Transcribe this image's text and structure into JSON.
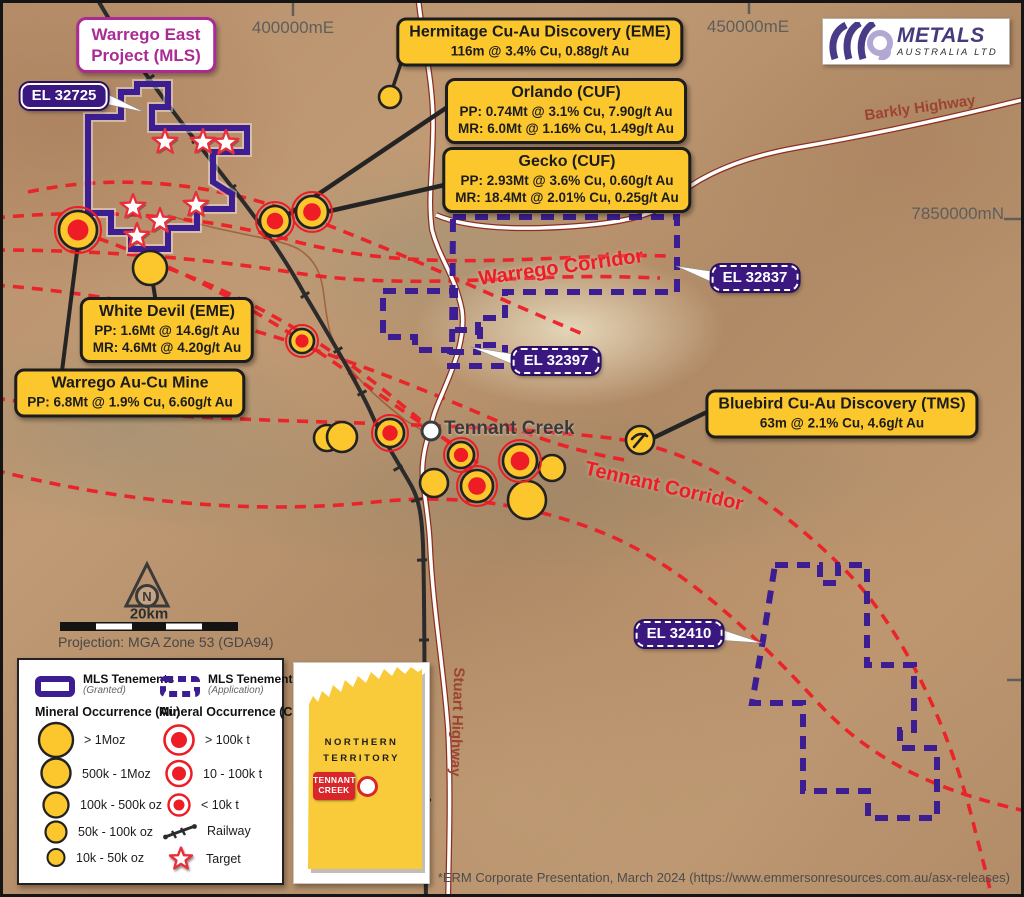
{
  "map": {
    "coordinates": {
      "e400": "400000mE",
      "e450": "450000mE",
      "n7850": "7850000mN"
    },
    "project_label": {
      "line1": "Warrego East",
      "line2": "Project (MLS)"
    },
    "tenement_labels": {
      "granted": "EL 32725",
      "app1": "EL 32837",
      "app2": "EL 32397",
      "app3": "EL 32410"
    },
    "corridors": {
      "warrego": "Warrego Corridor",
      "tennant": "Tennant Corridor"
    },
    "highways": {
      "barkly": "Barkly Highway",
      "stuart": "Stuart Highway"
    },
    "town": "Tennant Creek",
    "north": "N",
    "scale": {
      "label": "20km",
      "projection": "Projection: MGA Zone 53 (GDA94)"
    }
  },
  "callouts": {
    "hermitage": {
      "title": "Hermitage Cu-Au Discovery (EME)",
      "line1": "116m @ 3.4% Cu, 0.88g/t Au"
    },
    "orlando": {
      "title": "Orlando (CUF)",
      "line1": "PP: 0.74Mt @ 3.1% Cu, 7.90g/t Au",
      "line2": "MR: 6.0Mt @ 1.16% Cu, 1.49g/t Au"
    },
    "gecko": {
      "title": "Gecko (CUF)",
      "line1": "PP: 2.93Mt @ 3.6% Cu, 0.60g/t Au",
      "line2": "MR: 18.4Mt @ 2.01% Cu, 0.25g/t Au"
    },
    "white_devil": {
      "title": "White Devil (EME)",
      "line1": "PP: 1.6Mt @ 14.6g/t Au",
      "line2": "MR: 4.6Mt @ 4.20g/t Au"
    },
    "warrego_mine": {
      "title": "Warrego Au-Cu Mine",
      "line1": "PP: 6.8Mt @ 1.9% Cu, 6.60g/t Au"
    },
    "bluebird": {
      "title": "Bluebird Cu-Au Discovery (TMS)",
      "line1": "63m @ 2.1% Cu, 4.6g/t Au"
    }
  },
  "legend": {
    "tenements_granted": {
      "title": "MLS Tenements",
      "sub": "(Granted)"
    },
    "tenements_application": {
      "title": "MLS Tenements",
      "sub": "(Application)"
    },
    "au_header": "Mineral Occurrence (Au)",
    "cu_header": "Mineral Occurrence (Cu)",
    "au_items": [
      "> 1Moz",
      "500k - 1Moz",
      "100k - 500k oz",
      "50k - 100k oz",
      "10k - 50k oz"
    ],
    "cu_items": [
      "> 100k t",
      "10 - 100k t",
      "< 10k t"
    ],
    "railway": "Railway",
    "target": "Target"
  },
  "inset": {
    "line1": "NORTHERN",
    "line2": "TERRITORY",
    "town1": "TENNANT",
    "town2": "CREEK"
  },
  "logo": {
    "name": "METALS",
    "sub": "AUSTRALIA LTD"
  },
  "footer": "*ERM Corporate Presentation, March 2024 (https://www.emmersonresources.com.au/asx-releases)",
  "colors": {
    "callout_yellow": "#fcc72d",
    "tenement_purple": "#3d1e92",
    "label_purple": "#3a1880",
    "corridor_red": "#ee1c25",
    "occurrence_yellow": "#fcc72d",
    "occurrence_red": "#ee1c25",
    "marker_outline": "#222222",
    "star_red": "#e8303c",
    "magenta": "#aa2b94",
    "highway_label": "#9c4431",
    "railway_black": "#2b2b2b"
  },
  "markers": {
    "occurrences": [
      {
        "type": "au",
        "x": 390,
        "y": 97,
        "r": 11
      },
      {
        "type": "au",
        "x": 150,
        "y": 268,
        "r": 17
      },
      {
        "type": "au",
        "x": 327,
        "y": 438,
        "r": 13
      },
      {
        "type": "au",
        "x": 342,
        "y": 437,
        "r": 15
      },
      {
        "type": "au",
        "x": 434,
        "y": 483,
        "r": 14
      },
      {
        "type": "au",
        "x": 552,
        "y": 468,
        "r": 13
      },
      {
        "type": "au",
        "x": 527,
        "y": 500,
        "r": 19
      },
      {
        "type": "aucu",
        "x": 78,
        "y": 230,
        "r": 19
      },
      {
        "type": "aucu",
        "x": 275,
        "y": 221,
        "r": 15
      },
      {
        "type": "aucu",
        "x": 312,
        "y": 212,
        "r": 16
      },
      {
        "type": "aucu",
        "x": 302,
        "y": 341,
        "r": 12
      },
      {
        "type": "aucu",
        "x": 390,
        "y": 433,
        "r": 14
      },
      {
        "type": "aucu",
        "x": 461,
        "y": 455,
        "r": 13
      },
      {
        "type": "aucu",
        "x": 477,
        "y": 486,
        "r": 16
      },
      {
        "type": "aucu",
        "x": 520,
        "y": 461,
        "r": 17
      },
      {
        "type": "hammer",
        "x": 640,
        "y": 440,
        "r": 14
      },
      {
        "type": "town",
        "x": 431,
        "y": 431,
        "r": 9
      }
    ],
    "targets": [
      {
        "x": 165,
        "y": 142
      },
      {
        "x": 203,
        "y": 142
      },
      {
        "x": 226,
        "y": 143
      },
      {
        "x": 133,
        "y": 207
      },
      {
        "x": 196,
        "y": 205
      },
      {
        "x": 160,
        "y": 221
      },
      {
        "x": 137,
        "y": 236
      }
    ]
  }
}
